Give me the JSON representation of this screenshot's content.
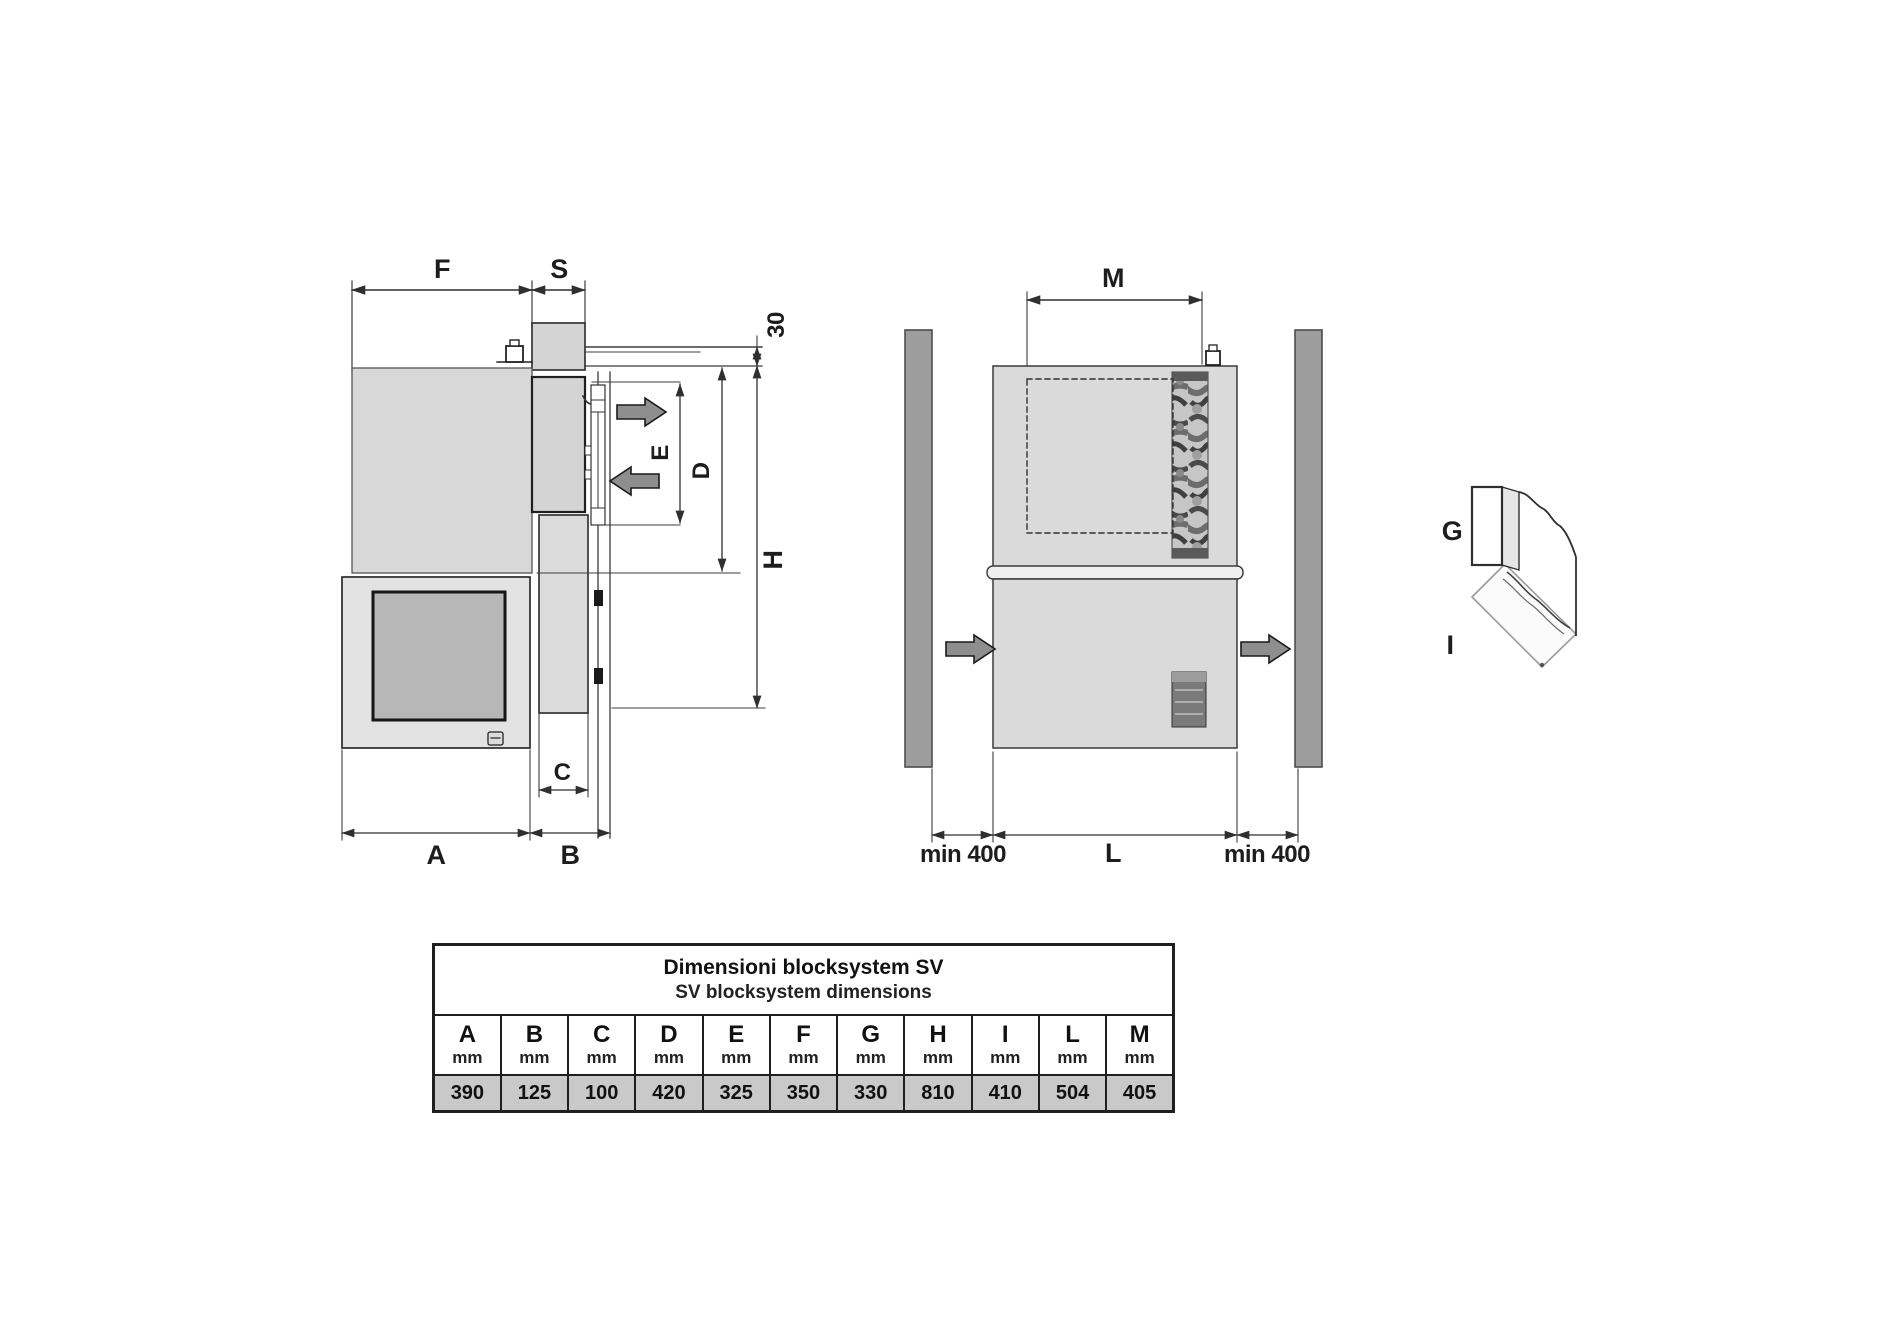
{
  "page": {
    "background": "#ffffff",
    "description_name": "blocksystem-sv-dimension-drawing"
  },
  "colors": {
    "line": "#2f2f2f",
    "dim_line": "#3c3c3c",
    "panel_gray": "#d8d8d8",
    "unit_gray": "#dadada",
    "fan_panel_gray": "#b7b7b7",
    "wall_bar_gray": "#9d9d9d",
    "table_value_row_bg": "#c9c9c9",
    "arrow_fill": "#8e8e8e"
  },
  "side_view": {
    "dim_labels": {
      "F": "F",
      "S": "S",
      "offset30": "30",
      "E": "E",
      "D": "D",
      "H": "H",
      "C": "C",
      "A": "A",
      "B": "B"
    }
  },
  "front_view": {
    "dim_labels": {
      "M": "M",
      "L": "L",
      "min_left": "min 400",
      "min_right": "min 400"
    }
  },
  "corner_detail": {
    "dim_labels": {
      "G": "G",
      "I": "I"
    }
  },
  "dimensions_table": {
    "title_line1": "Dimensioni blocksystem SV",
    "title_line2": "SV blocksystem dimensions",
    "unit_label": "mm",
    "columns": [
      "A",
      "B",
      "C",
      "D",
      "E",
      "F",
      "G",
      "H",
      "I",
      "L",
      "M"
    ],
    "values_mm": [
      "390",
      "125",
      "100",
      "420",
      "325",
      "350",
      "330",
      "810",
      "410",
      "504",
      "405"
    ]
  }
}
